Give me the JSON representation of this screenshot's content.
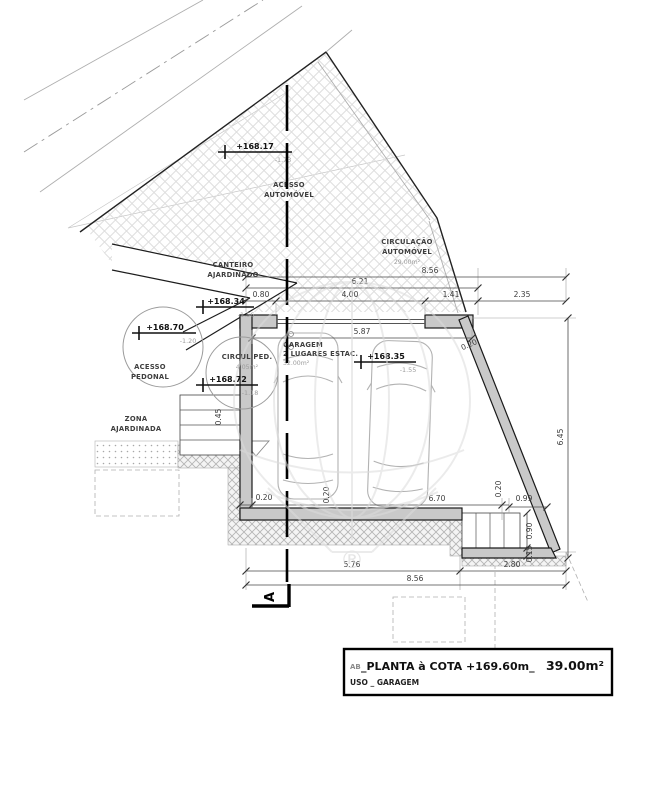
{
  "labels": {
    "acesso_automovel_1": "ACESSO",
    "acesso_automovel_2": "AUTOMÓVEL",
    "circulacao_1": "CIRCULAÇÃO",
    "circulacao_2": "AUTOMÓVEL",
    "circulacao_area": "29.00m²",
    "canteiro_1": "CANTEIRO",
    "canteiro_2": "AJARDINADO",
    "acesso_pedonal_1": "ACESSO",
    "acesso_pedonal_2": "PEDONAL",
    "circul_ped": "CIRCUL PED.",
    "circul_ped_area": "4.05m²",
    "zona_1": "ZONA",
    "zona_2": "AJARDINADA",
    "garagem": "GARAGEM",
    "garagem_sub": "2 LUGARES ESTAC.",
    "garagem_area": "32.00m²"
  },
  "levels": {
    "l1": {
      "value": "+168.17",
      "depth": "-1.73"
    },
    "l2": {
      "value": "+168.34",
      "depth": "-1.56"
    },
    "l3": {
      "value": "+168.70",
      "depth": "-1.20"
    },
    "l4": {
      "value": "+168.72",
      "depth": "-1.18"
    },
    "l5": {
      "value": "+168.35",
      "depth": "-1.55"
    }
  },
  "dimensions": {
    "top_856": "8.56",
    "top_621": "6.21",
    "top_080": "0.80",
    "top_400": "4.00",
    "top_141": "1.41",
    "top_235": "2.35",
    "door_587": "5.87",
    "wall_020": "0.20",
    "bot_020_left": "0.20",
    "bot_020_mid": "0.20",
    "bot_670": "6.70",
    "bot_020_right": "0.20",
    "bot_099": "0.99",
    "stair_090": "0.90",
    "stair_015": "0.15",
    "steps_045": "0.45",
    "right_645": "6.45",
    "low_576": "5.76",
    "low_280": "2.80",
    "low_856": "8.56"
  },
  "section": {
    "label": "A"
  },
  "watermark": {
    "registered": "®"
  },
  "title_block": {
    "code": "AB",
    "title": "_PLANTA à COTA +169.60m_",
    "area": "39.00m²",
    "use_line": "USO _ GARAGEM"
  }
}
